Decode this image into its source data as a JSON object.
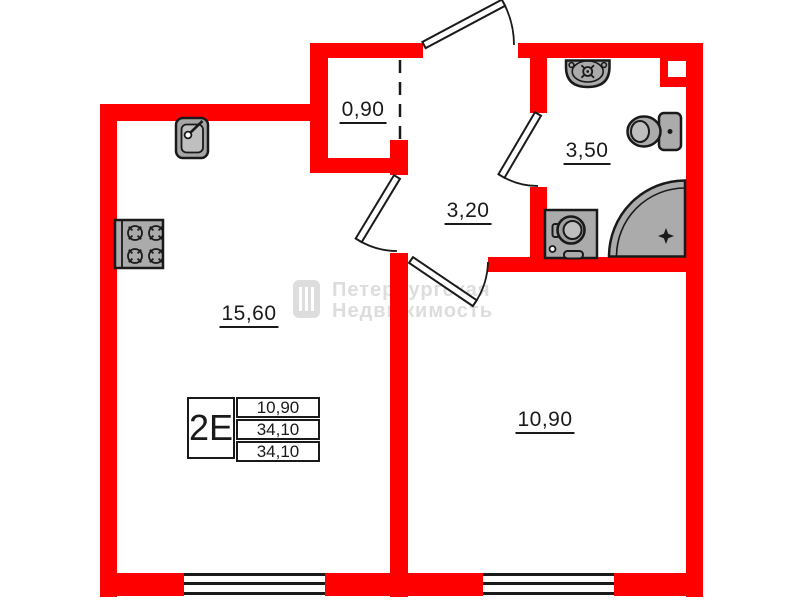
{
  "plan_title": "apartment-floor-plan",
  "rooms": {
    "kitchen_living": {
      "area": "15,60"
    },
    "wardrobe": {
      "area": "0,90"
    },
    "hallway": {
      "area": "3,20"
    },
    "bathroom": {
      "area": "3,50"
    },
    "bedroom": {
      "area": "10,90"
    }
  },
  "stamp": {
    "unit_type": "2Е",
    "rows": [
      "10,90",
      "34,10",
      "34,10"
    ]
  },
  "watermark": {
    "line1": "Петербургская",
    "line2": "Недвижимость"
  },
  "colors": {
    "wall": "#ff0000",
    "lines": "#1a1a1a",
    "fixture_fill": "#ababab",
    "fixture_inner": "#bfbfbf",
    "watermark": "#c2c2c2"
  },
  "fixtures": [
    "kitchen-sink",
    "stove",
    "bathroom-sink",
    "toilet",
    "washing-machine",
    "shower-tray"
  ],
  "doors": [
    "entrance-door",
    "bathroom-door",
    "kitchen-door",
    "bedroom-door"
  ]
}
